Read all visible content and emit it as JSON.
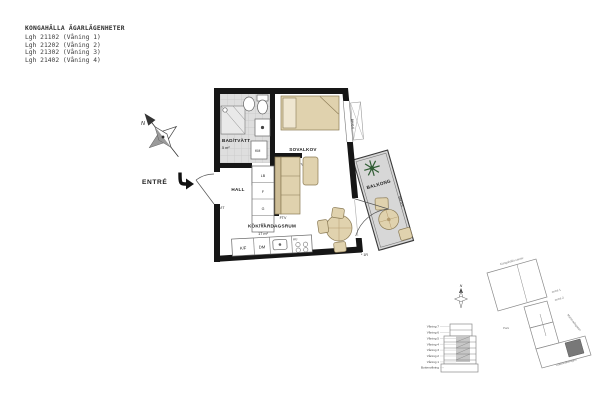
{
  "title_block": {
    "title": "KONGAHÄLLA ÄGARLÄGENHETER",
    "apartments": [
      "Lgh 21102 (Våning 1)",
      "Lgh 21202 (Våning 2)",
      "Lgh 21302 (Våning 3)",
      "Lgh 21402 (Våning 4)"
    ]
  },
  "plan": {
    "entry": "ENTRÉ",
    "north": "N",
    "rooms": {
      "bathroom": {
        "name": "BAD/TVÄTT",
        "area": "5 m²"
      },
      "sleeping_alcove": {
        "name": "SOVALKOV",
        "area": "6 m²"
      },
      "hall": {
        "name": "HALL"
      },
      "kitchen_living": {
        "name": "KÖK/VARDAGSRUM",
        "area": "17 m²"
      },
      "balcony": {
        "name": "BALKONG"
      }
    },
    "fixtures": {
      "fridge_freezer": "K/F",
      "dishwasher": "DM",
      "hob": "KU",
      "washer": "KM",
      "electrical": "EL/IT"
    },
    "closets": {
      "c1": "LB",
      "c2": "F",
      "c3": "G",
      "c4": "ST"
    },
    "outlets": {
      "tv": "FTV"
    },
    "railings": {
      "upper": "BH 0.6",
      "balcony": "BH 0.5"
    },
    "reference": "* 1R"
  },
  "site": {
    "north": "N",
    "floors": [
      "Våning 7",
      "Våning 6",
      "Våning 5",
      "Våning 4",
      "Våning 3",
      "Våning 2",
      "Våning 1",
      "Bottenvåning"
    ],
    "labels": {
      "park": "Park",
      "center": "Kongahälla center",
      "street_right": "Marknadsgatan",
      "street_bottom": "Uddevallavägen",
      "entrance1": "entré 1",
      "entrance2": "entré 2"
    }
  },
  "colors": {
    "wall": "#161616",
    "furniture": "#e0d2ae",
    "furniture_dark": "#cdbd97",
    "floor_gray": "#d7d7d7",
    "plant": "#2f5c33"
  }
}
